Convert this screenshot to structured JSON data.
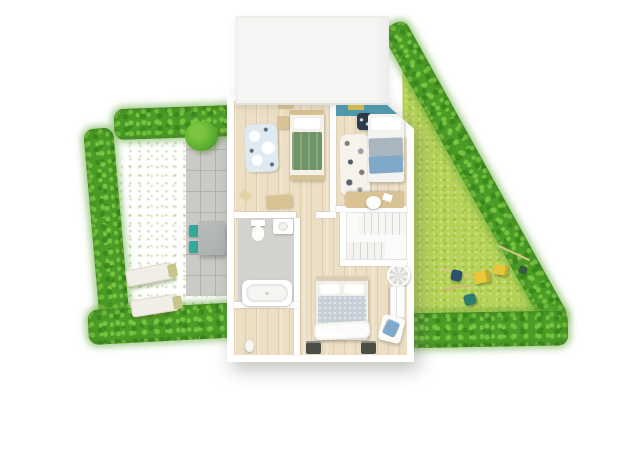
{
  "scene": {
    "type": "3d-floor-plan-render",
    "background": "#ffffff",
    "text_visible": []
  },
  "colors": {
    "lawn-left": "#bdd667",
    "lawn-right": "#b6d356",
    "hedge-base": "#4c9d28",
    "hedge-dark": "#3c8a1e",
    "hedge-light": "#7ac440",
    "patio": "#cacbc6",
    "patio-line": "#b1b2ad",
    "wood-a": "#ecdfc4",
    "wall": "#ffffff",
    "roof": "#f5f5f3",
    "blue-wall": "#4f99b0",
    "green-blanket": "#6f9468",
    "duvet": "#c6cfd5",
    "blanket-gray": "#aab6bf",
    "blanket-blue": "#7fa8c9",
    "teal": "#35a79c",
    "table-gray": "#aeb2b0",
    "lounger": "#f1eee5",
    "tan": "#d9c293",
    "navy": "#2c3a49",
    "bath-floor": "#d2d3cf",
    "toy-yellow": "#e6c838",
    "toy-blue": "#2b506e",
    "toy-teal": "#2e7d6e",
    "nightstand": "#4a4f46",
    "rug-blue": "#dfeaf2",
    "rug-white": "#f6f3ec",
    "bush": "#5fb233"
  },
  "garden_left": {
    "features": [
      "hedge-left",
      "hedge-top",
      "hedge-bottom",
      "lawn",
      "concrete-patio",
      "round-bush",
      "doormat"
    ],
    "furniture": [
      "patio-dining-table",
      "patio-chair x2",
      "sun-lounger x2",
      "lounger-cushion x2"
    ]
  },
  "garden_right": {
    "shape": "triangle",
    "features": [
      "hedge-diagonal",
      "hedge-bottom",
      "lawn"
    ],
    "toys": [
      "garden-stick x3",
      "toy-truck-yellow x2",
      "toy-blue",
      "toy-teal",
      "toy-dark"
    ]
  },
  "house": {
    "structure": [
      "roof-block",
      "outer-walls",
      "beveled-top-right-corner",
      "interior-walls"
    ],
    "rooms": [
      {
        "name": "kids-bedroom-left",
        "floor": "wood",
        "items": [
          "bed-green",
          "play-rug-clouds",
          "nightstand-small",
          "wall-shelf",
          "bench",
          "small-stool"
        ]
      },
      {
        "name": "kids-bedroom-right",
        "floor": "wood",
        "items": [
          "blue-accent-wall",
          "wall-shelf-yellow",
          "bed-blue-gray",
          "dark-chair",
          "animal-print-rug",
          "desk",
          "desk-chair",
          "paper"
        ]
      },
      {
        "name": "bathroom",
        "floor": "gray-tile",
        "items": [
          "toilet",
          "vanity-sink",
          "bathtub"
        ]
      },
      {
        "name": "staircase",
        "items": [
          "upper-flight",
          "landing",
          "lower-flight"
        ]
      },
      {
        "name": "hallway",
        "floor": "wood",
        "items": [
          "vase"
        ]
      },
      {
        "name": "master-bedroom",
        "floor": "wood",
        "items": [
          "double-bed",
          "pillow x2",
          "white-throw",
          "nightstand-dark x2",
          "wardrobe",
          "armchair-blue",
          "round-chair"
        ]
      }
    ]
  }
}
